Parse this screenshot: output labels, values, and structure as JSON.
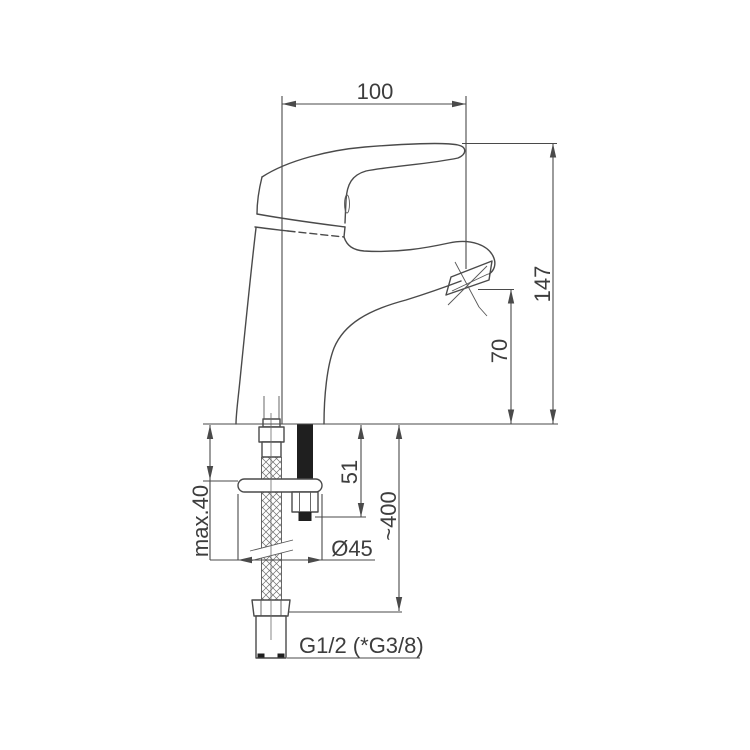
{
  "drawing": {
    "name": "basin-mixer-tap-dimension-drawing",
    "background": "#ffffff",
    "line_color": "#4a4a4a",
    "text_color": "#3d3d3d",
    "labels": {
      "spout_reach": "100",
      "total_height": "147",
      "spout_height": "70",
      "max_deck_thickness": "max.40",
      "under_deck_stud": "51",
      "hose_length": "~400",
      "base_diameter": "Ø45",
      "thread_size": "G1/2 (*G3/8)"
    }
  }
}
